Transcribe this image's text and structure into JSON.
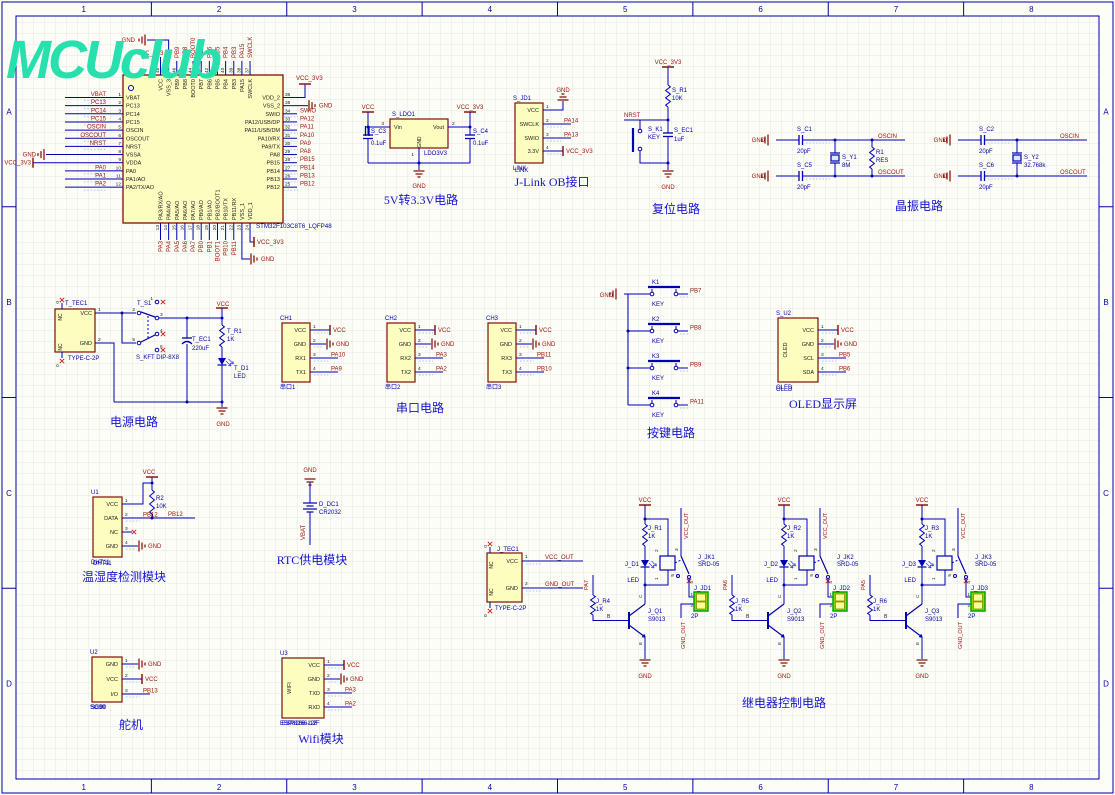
{
  "sheet": {
    "logo": "MCUclub",
    "zones_h": [
      "1",
      "2",
      "3",
      "4",
      "5",
      "6",
      "7",
      "8"
    ],
    "zones_v": [
      "A",
      "B",
      "C",
      "D"
    ]
  },
  "mcu": {
    "designator": "STM32F103C8T6_LQFP48",
    "pins_left": [
      {
        "num": "1",
        "name": "VBAT",
        "net": "VBAT",
        "kind": "net"
      },
      {
        "num": "2",
        "name": "PC13",
        "net": "PC13",
        "kind": "net"
      },
      {
        "num": "3",
        "name": "PC14",
        "net": "PC14",
        "kind": "net"
      },
      {
        "num": "4",
        "name": "PC15",
        "net": "PC15",
        "kind": "net"
      },
      {
        "num": "5",
        "name": "OSCIN",
        "net": "OSCIN",
        "kind": "net"
      },
      {
        "num": "6",
        "name": "OSCOUT",
        "net": "OSCOUT",
        "kind": "net"
      },
      {
        "num": "7",
        "name": "NRST",
        "net": "NRST",
        "kind": "net"
      },
      {
        "num": "8",
        "name": "VSSA",
        "net": "GND",
        "kind": "gnd"
      },
      {
        "num": "9",
        "name": "VDDA",
        "net": "VCC_3V3",
        "kind": "vcc"
      },
      {
        "num": "10",
        "name": "PA0",
        "net": "PA0",
        "kind": "net"
      },
      {
        "num": "11",
        "name": "PA1/AO",
        "net": "PA1",
        "kind": "net"
      },
      {
        "num": "12",
        "name": "PA2/TX/AO",
        "net": "PA2",
        "kind": "net"
      }
    ],
    "pins_right": [
      {
        "num": "36",
        "name": "VDD_2",
        "net": "VCC_3V3",
        "kind": "vcc"
      },
      {
        "num": "35",
        "name": "VSS_2",
        "net": "GND",
        "kind": "gnd"
      },
      {
        "num": "34",
        "name": "SWIO",
        "net": "SWIO",
        "kind": "net"
      },
      {
        "num": "33",
        "name": "PA12/USB/DP",
        "net": "PA12",
        "kind": "net"
      },
      {
        "num": "32",
        "name": "PA11/USB/DM",
        "net": "PA11",
        "kind": "net"
      },
      {
        "num": "31",
        "name": "PA10/RX",
        "net": "PA10",
        "kind": "net"
      },
      {
        "num": "30",
        "name": "PA9/TX",
        "net": "PA9",
        "kind": "net"
      },
      {
        "num": "29",
        "name": "PA8",
        "net": "PA8",
        "kind": "net"
      },
      {
        "num": "28",
        "name": "PB15",
        "net": "PB15",
        "kind": "net"
      },
      {
        "num": "27",
        "name": "PB14",
        "net": "PB14",
        "kind": "net"
      },
      {
        "num": "26",
        "name": "PB13",
        "net": "PB13",
        "kind": "net"
      },
      {
        "num": "25",
        "name": "PB12",
        "net": "PB12",
        "kind": "net"
      }
    ],
    "pins_top": [
      {
        "num": "48",
        "name": "VCC",
        "net": "VCC_3V3",
        "kind": "vcc"
      },
      {
        "num": "47",
        "name": "VSS_3",
        "net": "GND",
        "kind": "gnd"
      },
      {
        "num": "46",
        "name": "PB9",
        "net": "PB9",
        "kind": "net"
      },
      {
        "num": "45",
        "name": "PB8",
        "net": "PB8",
        "kind": "net"
      },
      {
        "num": "44",
        "name": "BOOT0",
        "net": "BOOT0",
        "kind": "net"
      },
      {
        "num": "43",
        "name": "PB7",
        "net": "PB7",
        "kind": "net"
      },
      {
        "num": "42",
        "name": "PB6",
        "net": "PB6",
        "kind": "net"
      },
      {
        "num": "41",
        "name": "PB5",
        "net": "PB5",
        "kind": "net"
      },
      {
        "num": "40",
        "name": "PB4",
        "net": "PB4",
        "kind": "net"
      },
      {
        "num": "39",
        "name": "PB3",
        "net": "PB3",
        "kind": "net"
      },
      {
        "num": "38",
        "name": "PA15",
        "net": "PA15",
        "kind": "net"
      },
      {
        "num": "37",
        "name": "SWCLK",
        "net": "SWCLK",
        "kind": "net"
      }
    ],
    "pins_bottom": [
      {
        "num": "13",
        "name": "PA3/RX/AO",
        "net": "PA3",
        "kind": "net"
      },
      {
        "num": "14",
        "name": "PA4/AO",
        "net": "PA4",
        "kind": "net"
      },
      {
        "num": "15",
        "name": "PA5/AO",
        "net": "PA5",
        "kind": "net"
      },
      {
        "num": "16",
        "name": "PA6/AO",
        "net": "PA6",
        "kind": "net"
      },
      {
        "num": "17",
        "name": "PA7/AO",
        "net": "PA7",
        "kind": "net"
      },
      {
        "num": "18",
        "name": "PB0/AO",
        "net": "PB0",
        "kind": "net"
      },
      {
        "num": "19",
        "name": "PB1/AO",
        "net": "PB1",
        "kind": "net"
      },
      {
        "num": "20",
        "name": "PB2/BOOT1",
        "net": "BOOT1",
        "kind": "net"
      },
      {
        "num": "21",
        "name": "PB10/TX",
        "net": "PB10",
        "kind": "net"
      },
      {
        "num": "22",
        "name": "PB11/RX",
        "net": "PB11",
        "kind": "net"
      },
      {
        "num": "23",
        "name": "VSS_1",
        "net": "GND",
        "kind": "gnd"
      },
      {
        "num": "24",
        "name": "VDD_1",
        "net": "VCC_3V3",
        "kind": "vcc"
      }
    ]
  },
  "ldo": {
    "title": "5V转3.3V电路",
    "d": "S_LDO1",
    "part": "LDO3V3",
    "pin_vin": {
      "num": "3",
      "name": "Vin"
    },
    "pin_vout": {
      "num": "2",
      "name": "Vout"
    },
    "pin_gnd": {
      "num": "1",
      "name": "GND"
    },
    "c3": {
      "d": "S_C3",
      "v": "0.1uF"
    },
    "c4": {
      "d": "S_C4",
      "v": "0.1uF"
    },
    "nets": {
      "in": "VCC",
      "out": "VCC_3V3",
      "gnd": "GND"
    }
  },
  "jlink": {
    "title": "J-Link OB接口",
    "d": "S_JD1",
    "part": "LINK",
    "pins": [
      {
        "num": "1",
        "name": "VCC",
        "net": "GND",
        "kind": "gnd-top"
      },
      {
        "num": "2",
        "name": "SWCLK",
        "net": "PA14",
        "kind": "net"
      },
      {
        "num": "3",
        "name": "SWIO",
        "net": "PA13",
        "kind": "net"
      },
      {
        "num": "4",
        "name": "3.3V",
        "net": "VCC_3V3",
        "kind": "vcc"
      }
    ]
  },
  "reset": {
    "title": "复位电路",
    "nets": {
      "vcc": "VCC_3V3",
      "nrst": "NRST",
      "gnd": "GND"
    },
    "r": {
      "d": "S_R1",
      "v": "10K"
    },
    "k": {
      "d": "S_K1",
      "v": "KEY"
    },
    "c": {
      "d": "S_EC1",
      "v": "1uF"
    }
  },
  "xtal": {
    "title": "晶振电路",
    "groups": [
      {
        "gnd": "GND",
        "ct": {
          "d": "S_C1",
          "v": "20pF"
        },
        "cb": {
          "d": "S_C5",
          "v": "20pF"
        },
        "y": {
          "d": "S_Y1",
          "v": "8M"
        },
        "r": {
          "d": "R1",
          "v": "RES"
        },
        "net_top": "OSCIN",
        "net_bot": "OSCOUT"
      },
      {
        "gnd": "GND",
        "ct": {
          "d": "S_C2",
          "v": "20pF"
        },
        "cb": {
          "d": "S_C6",
          "v": "20pF"
        },
        "y": {
          "d": "S_Y2",
          "v": "32.768k"
        },
        "r": null,
        "net_top": "OSCIN",
        "net_bot": "OSCOUT"
      }
    ]
  },
  "pwr": {
    "title": "电源电路",
    "tec": {
      "d": "T_TEC1",
      "part": "TYPE-C-2P",
      "nc": "NC",
      "shell": "0",
      "pins": [
        {
          "num": "1",
          "name": "VCC"
        },
        {
          "num": "2",
          "name": "GND"
        }
      ]
    },
    "sw": {
      "d": "T_S1",
      "part": "S_KFT DIP-8X8",
      "nums": [
        "1",
        "2",
        "3",
        "4",
        "5",
        "6"
      ]
    },
    "ec": {
      "d": "T_EC1",
      "v": "220uF"
    },
    "r": {
      "d": "T_R1",
      "v": "1K"
    },
    "led": {
      "d": "T_D1",
      "v": "LED"
    },
    "nets": {
      "vcc": "VCC",
      "gnd": "GND"
    }
  },
  "serial": {
    "title": "串口电路",
    "conns": [
      {
        "d": "CH1",
        "part": "串口1",
        "pins": [
          {
            "num": "1",
            "name": "VCC",
            "net": "VCC",
            "kind": "vcc"
          },
          {
            "num": "2",
            "name": "GND",
            "net": "GND",
            "kind": "gnd"
          },
          {
            "num": "3",
            "name": "RX1",
            "net": "PA10",
            "kind": "net"
          },
          {
            "num": "4",
            "name": "TX1",
            "net": "PA9",
            "kind": "net"
          }
        ]
      },
      {
        "d": "CH2",
        "part": "串口2",
        "pins": [
          {
            "num": "1",
            "name": "VCC",
            "net": "VCC",
            "kind": "vcc"
          },
          {
            "num": "2",
            "name": "GND",
            "net": "GND",
            "kind": "gnd"
          },
          {
            "num": "3",
            "name": "RX2",
            "net": "PA3",
            "kind": "net"
          },
          {
            "num": "4",
            "name": "TX2",
            "net": "PA2",
            "kind": "net"
          }
        ]
      },
      {
        "d": "CH3",
        "part": "串口3",
        "pins": [
          {
            "num": "1",
            "name": "VCC",
            "net": "VCC",
            "kind": "vcc"
          },
          {
            "num": "2",
            "name": "GND",
            "net": "GND",
            "kind": "gnd"
          },
          {
            "num": "3",
            "name": "RX3",
            "net": "PB11",
            "kind": "net"
          },
          {
            "num": "4",
            "name": "TX3",
            "net": "PB10",
            "kind": "net"
          }
        ]
      }
    ]
  },
  "keys": {
    "title": "按键电路",
    "gnd": "GND",
    "items": [
      {
        "d": "K1",
        "v": "KEY",
        "net": "PB7"
      },
      {
        "d": "K2",
        "v": "KEY",
        "net": "PB8"
      },
      {
        "d": "K3",
        "v": "KEY",
        "net": "PB9"
      },
      {
        "d": "K4",
        "v": "KEY",
        "net": "PA11"
      }
    ]
  },
  "oled": {
    "title": "OLED显示屏",
    "d": "S_U2",
    "part": "OLED",
    "body": "OLED",
    "pins": [
      {
        "num": "1",
        "name": "VCC",
        "net": "VCC",
        "kind": "vcc"
      },
      {
        "num": "2",
        "name": "GND",
        "net": "GND",
        "kind": "gnd"
      },
      {
        "num": "3",
        "name": "SCL",
        "net": "PB5",
        "kind": "net"
      },
      {
        "num": "4",
        "name": "SDA",
        "net": "PB6",
        "kind": "net"
      }
    ]
  },
  "dht": {
    "title": "温湿度检测模块",
    "d": "U1",
    "part": "DHT11",
    "vcc": "VCC",
    "r": {
      "d": "R2",
      "v": "10K"
    },
    "pins": [
      {
        "num": "1",
        "name": "VCC",
        "net": "VCC",
        "kind": "custom"
      },
      {
        "num": "2",
        "name": "DATA",
        "net": "PB12",
        "kind": "net"
      },
      {
        "num": "3",
        "name": "NC",
        "net": "",
        "kind": "nc"
      },
      {
        "num": "4",
        "name": "GND",
        "net": "GND",
        "kind": "gnd"
      }
    ]
  },
  "rtc": {
    "title": "RTC供电模块",
    "d": "D_DC1",
    "part": "CR2032",
    "gnd": "GND",
    "vbat": "VBAT"
  },
  "servo": {
    "title": "舵机",
    "d": "U2",
    "part": "SG90",
    "pins": [
      {
        "num": "1",
        "name": "GND",
        "net": "GND",
        "kind": "gnd"
      },
      {
        "num": "2",
        "name": "VCC",
        "net": "VCC",
        "kind": "vcc"
      },
      {
        "num": "3",
        "name": "I/O",
        "net": "PB13",
        "kind": "net"
      }
    ]
  },
  "wifi": {
    "title": "Wifi模块",
    "d": "U3",
    "part": "ESP8266-12F",
    "body": "WIFI",
    "pins": [
      {
        "num": "1",
        "name": "VCC",
        "net": "VCC",
        "kind": "vcc"
      },
      {
        "num": "2",
        "name": "GND",
        "net": "GND",
        "kind": "gnd"
      },
      {
        "num": "3",
        "name": "TXD",
        "net": "PA3",
        "kind": "net"
      },
      {
        "num": "4",
        "name": "RXD",
        "net": "PA2",
        "kind": "net"
      }
    ]
  },
  "otec": {
    "d": "J_TEC1",
    "part": "TYPE-C-2P",
    "nc": "NC",
    "shell": "0",
    "pins": [
      {
        "num": "1",
        "name": "VCC",
        "net": "VCC_OUT"
      },
      {
        "num": "2",
        "name": "GND",
        "net": "GND_OUT"
      }
    ]
  },
  "relay": {
    "title": "继电器控制电路",
    "b": "B",
    "c": "C",
    "e": "E",
    "nets": {
      "vcc": "VCC",
      "gnd": "GND",
      "vcc_out": "VCC_OUT",
      "gnd_out": "GND_OUT"
    },
    "chs": [
      {
        "input": "PA7",
        "rb": {
          "d": "J_R4",
          "v": "1K"
        },
        "q": {
          "d": "J_Q1",
          "v": "S9013"
        },
        "rc": {
          "d": "J_R1",
          "v": "1K"
        },
        "led": {
          "d": "J_D1",
          "v": "LED"
        },
        "jk": {
          "d": "J_JK1",
          "v": "SRD-05"
        },
        "jd": {
          "d": "J_JD1",
          "v": "2P"
        },
        "coil": [
          "2",
          "1"
        ],
        "swp": [
          "3",
          "5",
          "4"
        ],
        "cp": [
          "1",
          "2"
        ]
      },
      {
        "input": "PA6",
        "rb": {
          "d": "J_R5",
          "v": "1K"
        },
        "q": {
          "d": "J_Q2",
          "v": "S9013"
        },
        "rc": {
          "d": "J_R2",
          "v": "1K"
        },
        "led": {
          "d": "J_D2",
          "v": "LED"
        },
        "jk": {
          "d": "J_JK2",
          "v": "SRD-05"
        },
        "jd": {
          "d": "J_JD2",
          "v": "2P"
        },
        "coil": [
          "2",
          "1"
        ],
        "swp": [
          "3",
          "5",
          "4"
        ],
        "cp": [
          "1",
          "2"
        ]
      },
      {
        "input": "PA5",
        "rb": {
          "d": "J_R6",
          "v": "1K"
        },
        "q": {
          "d": "J_Q3",
          "v": "S9013"
        },
        "rc": {
          "d": "J_R3",
          "v": "1K"
        },
        "led": {
          "d": "J_D3",
          "v": "LED"
        },
        "jk": {
          "d": "J_JK3",
          "v": "SRD-05"
        },
        "jd": {
          "d": "J_JD3",
          "v": "2P"
        },
        "coil": [
          "2",
          "1"
        ],
        "swp": [
          "3",
          "5",
          "4"
        ],
        "cp": [
          "1",
          "2"
        ]
      }
    ]
  }
}
